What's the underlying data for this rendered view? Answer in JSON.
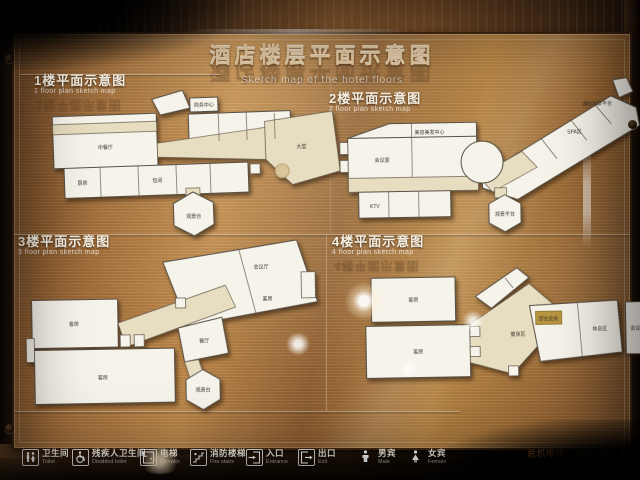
{
  "sign": {
    "title_zh": "酒店楼层平面示意图",
    "title_en": "Sketch map of the hotel floors"
  },
  "floors": [
    {
      "label_zh": "1楼平面示意图",
      "label_en": "1 floor plan sketch map",
      "rooms": [
        "中餐厅",
        "商务中心",
        "大堂",
        "厨房",
        "包间",
        "观景台"
      ]
    },
    {
      "label_zh": "2楼平面示意图",
      "label_en": "2 floor plan sketch map",
      "rooms": [
        "美容美发中心",
        "会议室",
        "KTV",
        "SPA区",
        "观景平台",
        "通往观景平台"
      ]
    },
    {
      "label_zh": "3楼平面示意图",
      "label_en": "3 floor plan sketch map",
      "rooms": [
        "客房",
        "客房",
        "会议厅",
        "客房",
        "餐厅",
        "观景台"
      ]
    },
    {
      "label_zh": "4楼平面示意图",
      "label_en": "4 floor plan sketch map",
      "rooms": [
        "客房",
        "客房",
        "健身区",
        "您在此处",
        "休息区",
        "会议室"
      ]
    }
  ],
  "legend": {
    "items": [
      {
        "zh": "卫生间",
        "en": "Toilet",
        "icon": "toilet-icon"
      },
      {
        "zh": "残疾人卫生间",
        "en": "Disabled toilet",
        "icon": "wheelchair-icon"
      },
      {
        "zh": "电梯",
        "en": "Elevator",
        "icon": "elevator-icon"
      },
      {
        "zh": "消防楼梯",
        "en": "Fire stairs",
        "icon": "fire-stairs-icon"
      },
      {
        "zh": "入口",
        "en": "Entrance",
        "icon": "entrance-icon"
      },
      {
        "zh": "出口",
        "en": "Exit",
        "icon": "exit-icon"
      },
      {
        "zh": "男宾",
        "en": "Male",
        "icon": "male-icon"
      },
      {
        "zh": "女宾",
        "en": "Female",
        "icon": "female-icon"
      }
    ]
  },
  "footer": {
    "phone_zh": "总机电话：0837-682 666",
    "phone_en": "telephone switchboard:0837-682 666"
  },
  "colors": {
    "panel_bronze": "#b5813f",
    "plan_fill": "#f6f3ea",
    "corridor_beige": "#e7ddc0",
    "marker_gold": "#b8963f",
    "phone_orange": "#e2873a"
  }
}
